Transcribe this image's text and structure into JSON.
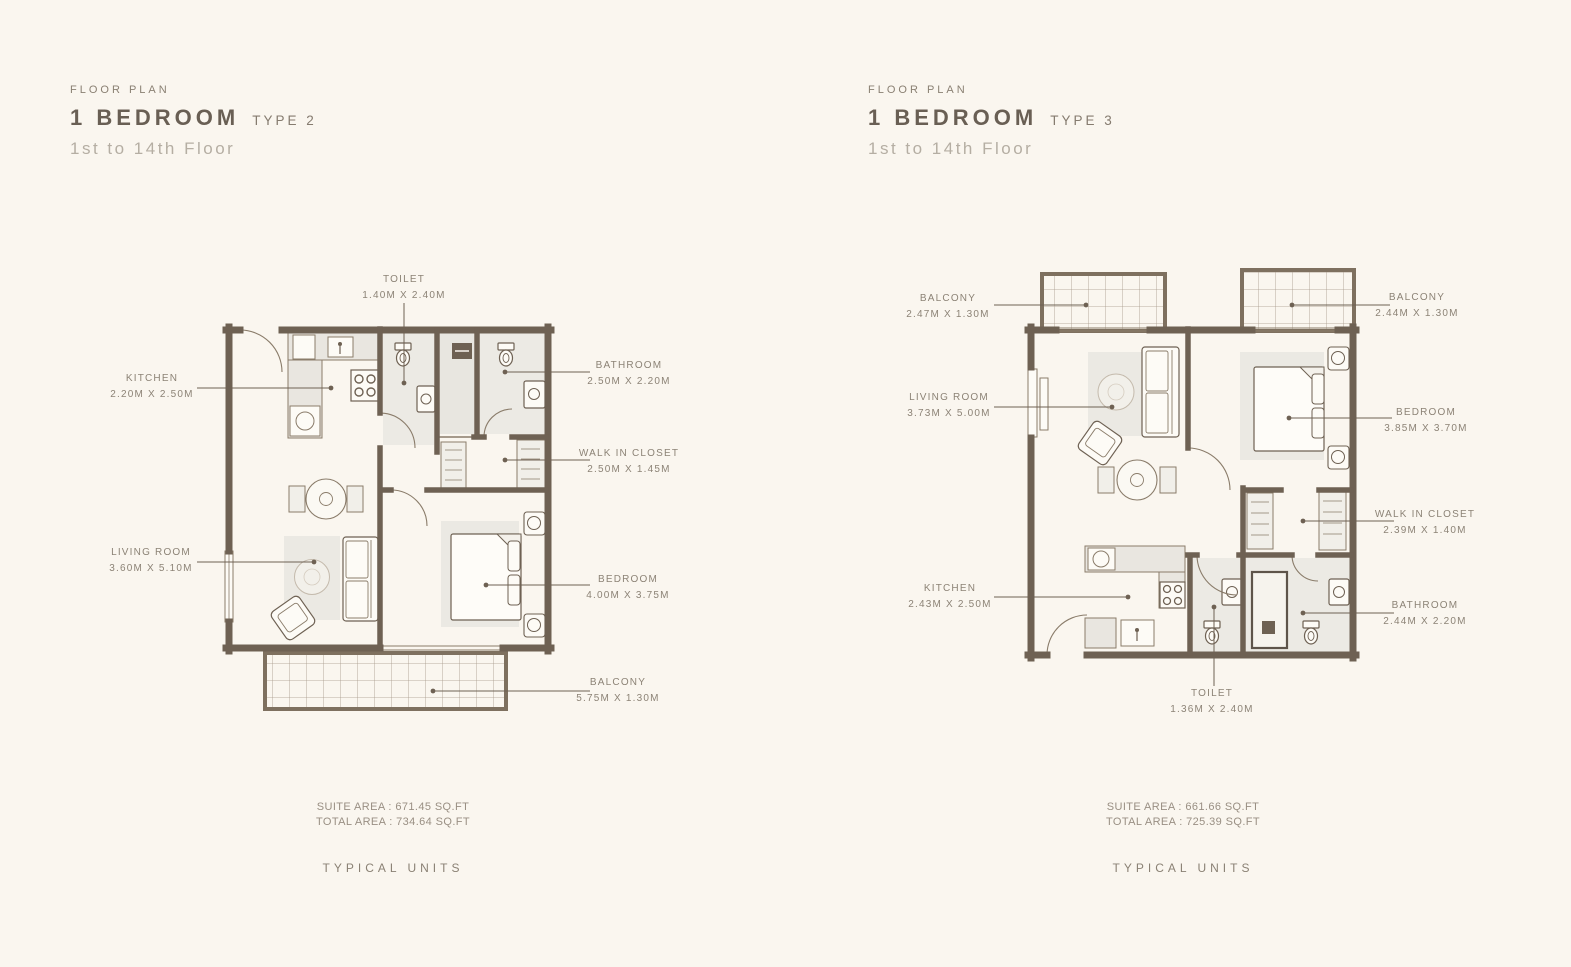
{
  "colors": {
    "background": "#FAF6EF",
    "wall": "#6E6153",
    "furniture_line": "#8A7C6A",
    "label_text": "#8C8376",
    "title_text": "#695F54",
    "muted_text": "#B5AEA3"
  },
  "plans": [
    {
      "eyebrow": "FLOOR PLAN",
      "title": "1 BEDROOM",
      "type": "TYPE 2",
      "floors": "1st to 14th Floor",
      "labels": {
        "toilet": {
          "name": "TOILET",
          "dims": "1.40M X 2.40M"
        },
        "kitchen": {
          "name": "KITCHEN",
          "dims": "2.20M X 2.50M"
        },
        "bathroom": {
          "name": "BATHROOM",
          "dims": "2.50M X 2.20M"
        },
        "walk_in_closet": {
          "name": "WALK IN CLOSET",
          "dims": "2.50M X 1.45M"
        },
        "living_room": {
          "name": "LIVING ROOM",
          "dims": "3.60M X 5.10M"
        },
        "bedroom": {
          "name": "BEDROOM",
          "dims": "4.00M X 3.75M"
        },
        "balcony": {
          "name": "BALCONY",
          "dims": "5.75M X 1.30M"
        }
      },
      "suite_area": "SUITE AREA : 671.45 SQ.FT",
      "total_area": "TOTAL AREA : 734.64 SQ.FT",
      "footer": "TYPICAL UNITS"
    },
    {
      "eyebrow": "FLOOR PLAN",
      "title": "1 BEDROOM",
      "type": "TYPE 3",
      "floors": "1st to 14th Floor",
      "labels": {
        "balcony_left": {
          "name": "BALCONY",
          "dims": "2.47M X 1.30M"
        },
        "balcony_right": {
          "name": "BALCONY",
          "dims": "2.44M X 1.30M"
        },
        "living_room": {
          "name": "LIVING ROOM",
          "dims": "3.73M X 5.00M"
        },
        "bedroom": {
          "name": "BEDROOM",
          "dims": "3.85M X 3.70M"
        },
        "walk_in_closet": {
          "name": "WALK IN CLOSET",
          "dims": "2.39M X 1.40M"
        },
        "kitchen": {
          "name": "KITCHEN",
          "dims": "2.43M X 2.50M"
        },
        "bathroom": {
          "name": "BATHROOM",
          "dims": "2.44M X 2.20M"
        },
        "toilet": {
          "name": "TOILET",
          "dims": "1.36M X 2.40M"
        }
      },
      "suite_area": "SUITE AREA : 661.66 SQ.FT",
      "total_area": "TOTAL AREA : 725.39 SQ.FT",
      "footer": "TYPICAL UNITS"
    }
  ]
}
